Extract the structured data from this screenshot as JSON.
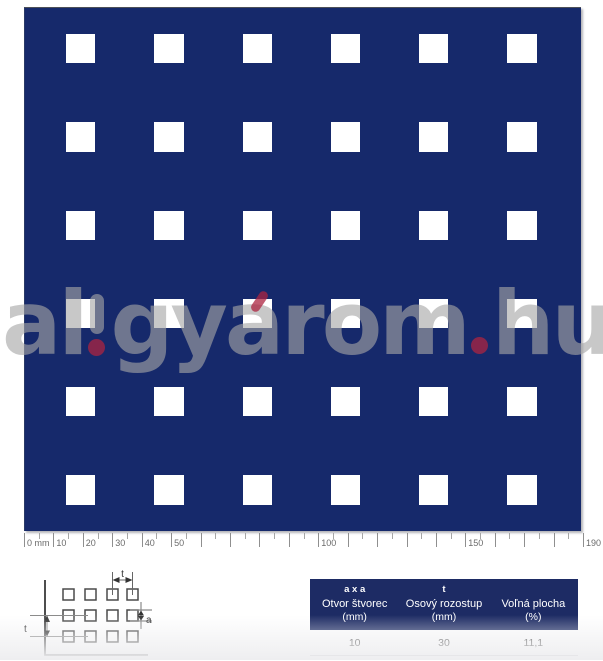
{
  "colors": {
    "panel_navy": "#16296B",
    "header_navy": "#1D2B64",
    "hole_white": "#FFFFFF",
    "watermark_gray": "#A6A6A6",
    "watermark_red": "#AC2440"
  },
  "pattern": {
    "rows": 6,
    "cols": 6,
    "hole_shape": "square",
    "hole_mm": 10,
    "pitch_mm": 30,
    "open_area_pct": "11,1"
  },
  "ruler": {
    "unit": "mm",
    "min": 0,
    "max": 190,
    "minor_step": 5,
    "major_step": 10,
    "labels": [
      {
        "mm": 0,
        "text": "0 mm"
      },
      {
        "mm": 10,
        "text": "10"
      },
      {
        "mm": 20,
        "text": "20"
      },
      {
        "mm": 30,
        "text": "30"
      },
      {
        "mm": 40,
        "text": "40"
      },
      {
        "mm": 50,
        "text": "50"
      },
      {
        "mm": 100,
        "text": "100"
      },
      {
        "mm": 150,
        "text": "150"
      },
      {
        "mm": 190,
        "text": "190"
      }
    ]
  },
  "watermark": {
    "text": "al!gyárom.hu",
    "segments": {
      "s1": "al",
      "s2": "gy",
      "s3": "a",
      "s4": "rom",
      "s5": "hu"
    }
  },
  "diagram": {
    "label_pitch_top": "t",
    "label_hole_size": "a",
    "label_pitch_left": "t"
  },
  "table": {
    "columns": [
      {
        "symbol": "a x a",
        "name": "Otvor štvorec",
        "unit": "(mm)",
        "value": "10"
      },
      {
        "symbol": "t",
        "name": "Osový rozostup",
        "unit": "(mm)",
        "value": "30"
      },
      {
        "symbol": "",
        "name": "Voľná plocha",
        "unit": "(%)",
        "value": "11,1"
      }
    ]
  }
}
